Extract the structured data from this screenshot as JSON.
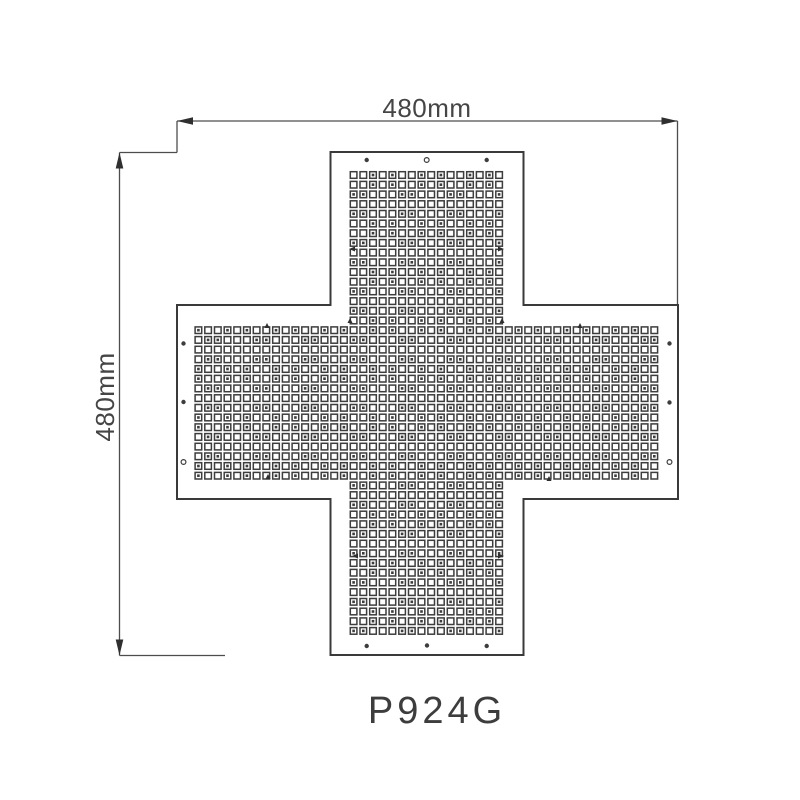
{
  "page": {
    "background_color": "#ffffff"
  },
  "drawing": {
    "type": "technical_drawing",
    "model_label": "P924G",
    "dimensions": {
      "width_label": "480mm",
      "height_label": "480mm"
    },
    "colors": {
      "background": "#ffffff",
      "outline": "#3a3a3a",
      "dim_line": "#4d4d4d",
      "arrow": "#2f2f2f",
      "dot": "#3d3d3d",
      "text": "#454545"
    },
    "cross": {
      "left": 177,
      "top": 152,
      "right": 678,
      "bottom": 655,
      "arm_left": 330.5,
      "arm_right": 523.5,
      "arm_top": 305,
      "arm_bottom": 499,
      "outline_width": 2
    },
    "led_grid": {
      "origin_x": 198.4,
      "origin_y": 175,
      "pitch": 9.7,
      "count": 48,
      "band_start": 16,
      "band_end": 31,
      "dot_size": 6.6,
      "dot_stroke": 1.5,
      "inner_size": 2.6
    },
    "holes": [
      {
        "x": 366.7,
        "y": 160,
        "style": "filled"
      },
      {
        "x": 426.7,
        "y": 160,
        "style": "hollow"
      },
      {
        "x": 486.7,
        "y": 160,
        "style": "filled"
      },
      {
        "x": 366.7,
        "y": 646,
        "style": "filled"
      },
      {
        "x": 427.0,
        "y": 645.5,
        "style": "filled"
      },
      {
        "x": 486.7,
        "y": 646,
        "style": "filled"
      },
      {
        "x": 183.5,
        "y": 343.5,
        "style": "filled"
      },
      {
        "x": 183.5,
        "y": 402,
        "style": "filled"
      },
      {
        "x": 183.5,
        "y": 462,
        "style": "hollow"
      },
      {
        "x": 669.5,
        "y": 343.5,
        "style": "filled"
      },
      {
        "x": 669.5,
        "y": 402.5,
        "style": "filled"
      },
      {
        "x": 669.5,
        "y": 462,
        "style": "hollow"
      }
    ],
    "marks": [
      {
        "x": 349,
        "y": 249,
        "dir": "left"
      },
      {
        "x": 504,
        "y": 249,
        "dir": "right"
      },
      {
        "x": 352,
        "y": 556,
        "dir": "left"
      },
      {
        "x": 504,
        "y": 556,
        "dir": "right"
      },
      {
        "x": 267,
        "y": 323,
        "dir": "up"
      },
      {
        "x": 580,
        "y": 323,
        "dir": "up"
      },
      {
        "x": 350,
        "y": 318,
        "dir": "up"
      },
      {
        "x": 502,
        "y": 318,
        "dir": "up"
      },
      {
        "x": 268,
        "y": 474,
        "dir": "up"
      },
      {
        "x": 549,
        "y": 476,
        "dir": "up"
      }
    ]
  }
}
